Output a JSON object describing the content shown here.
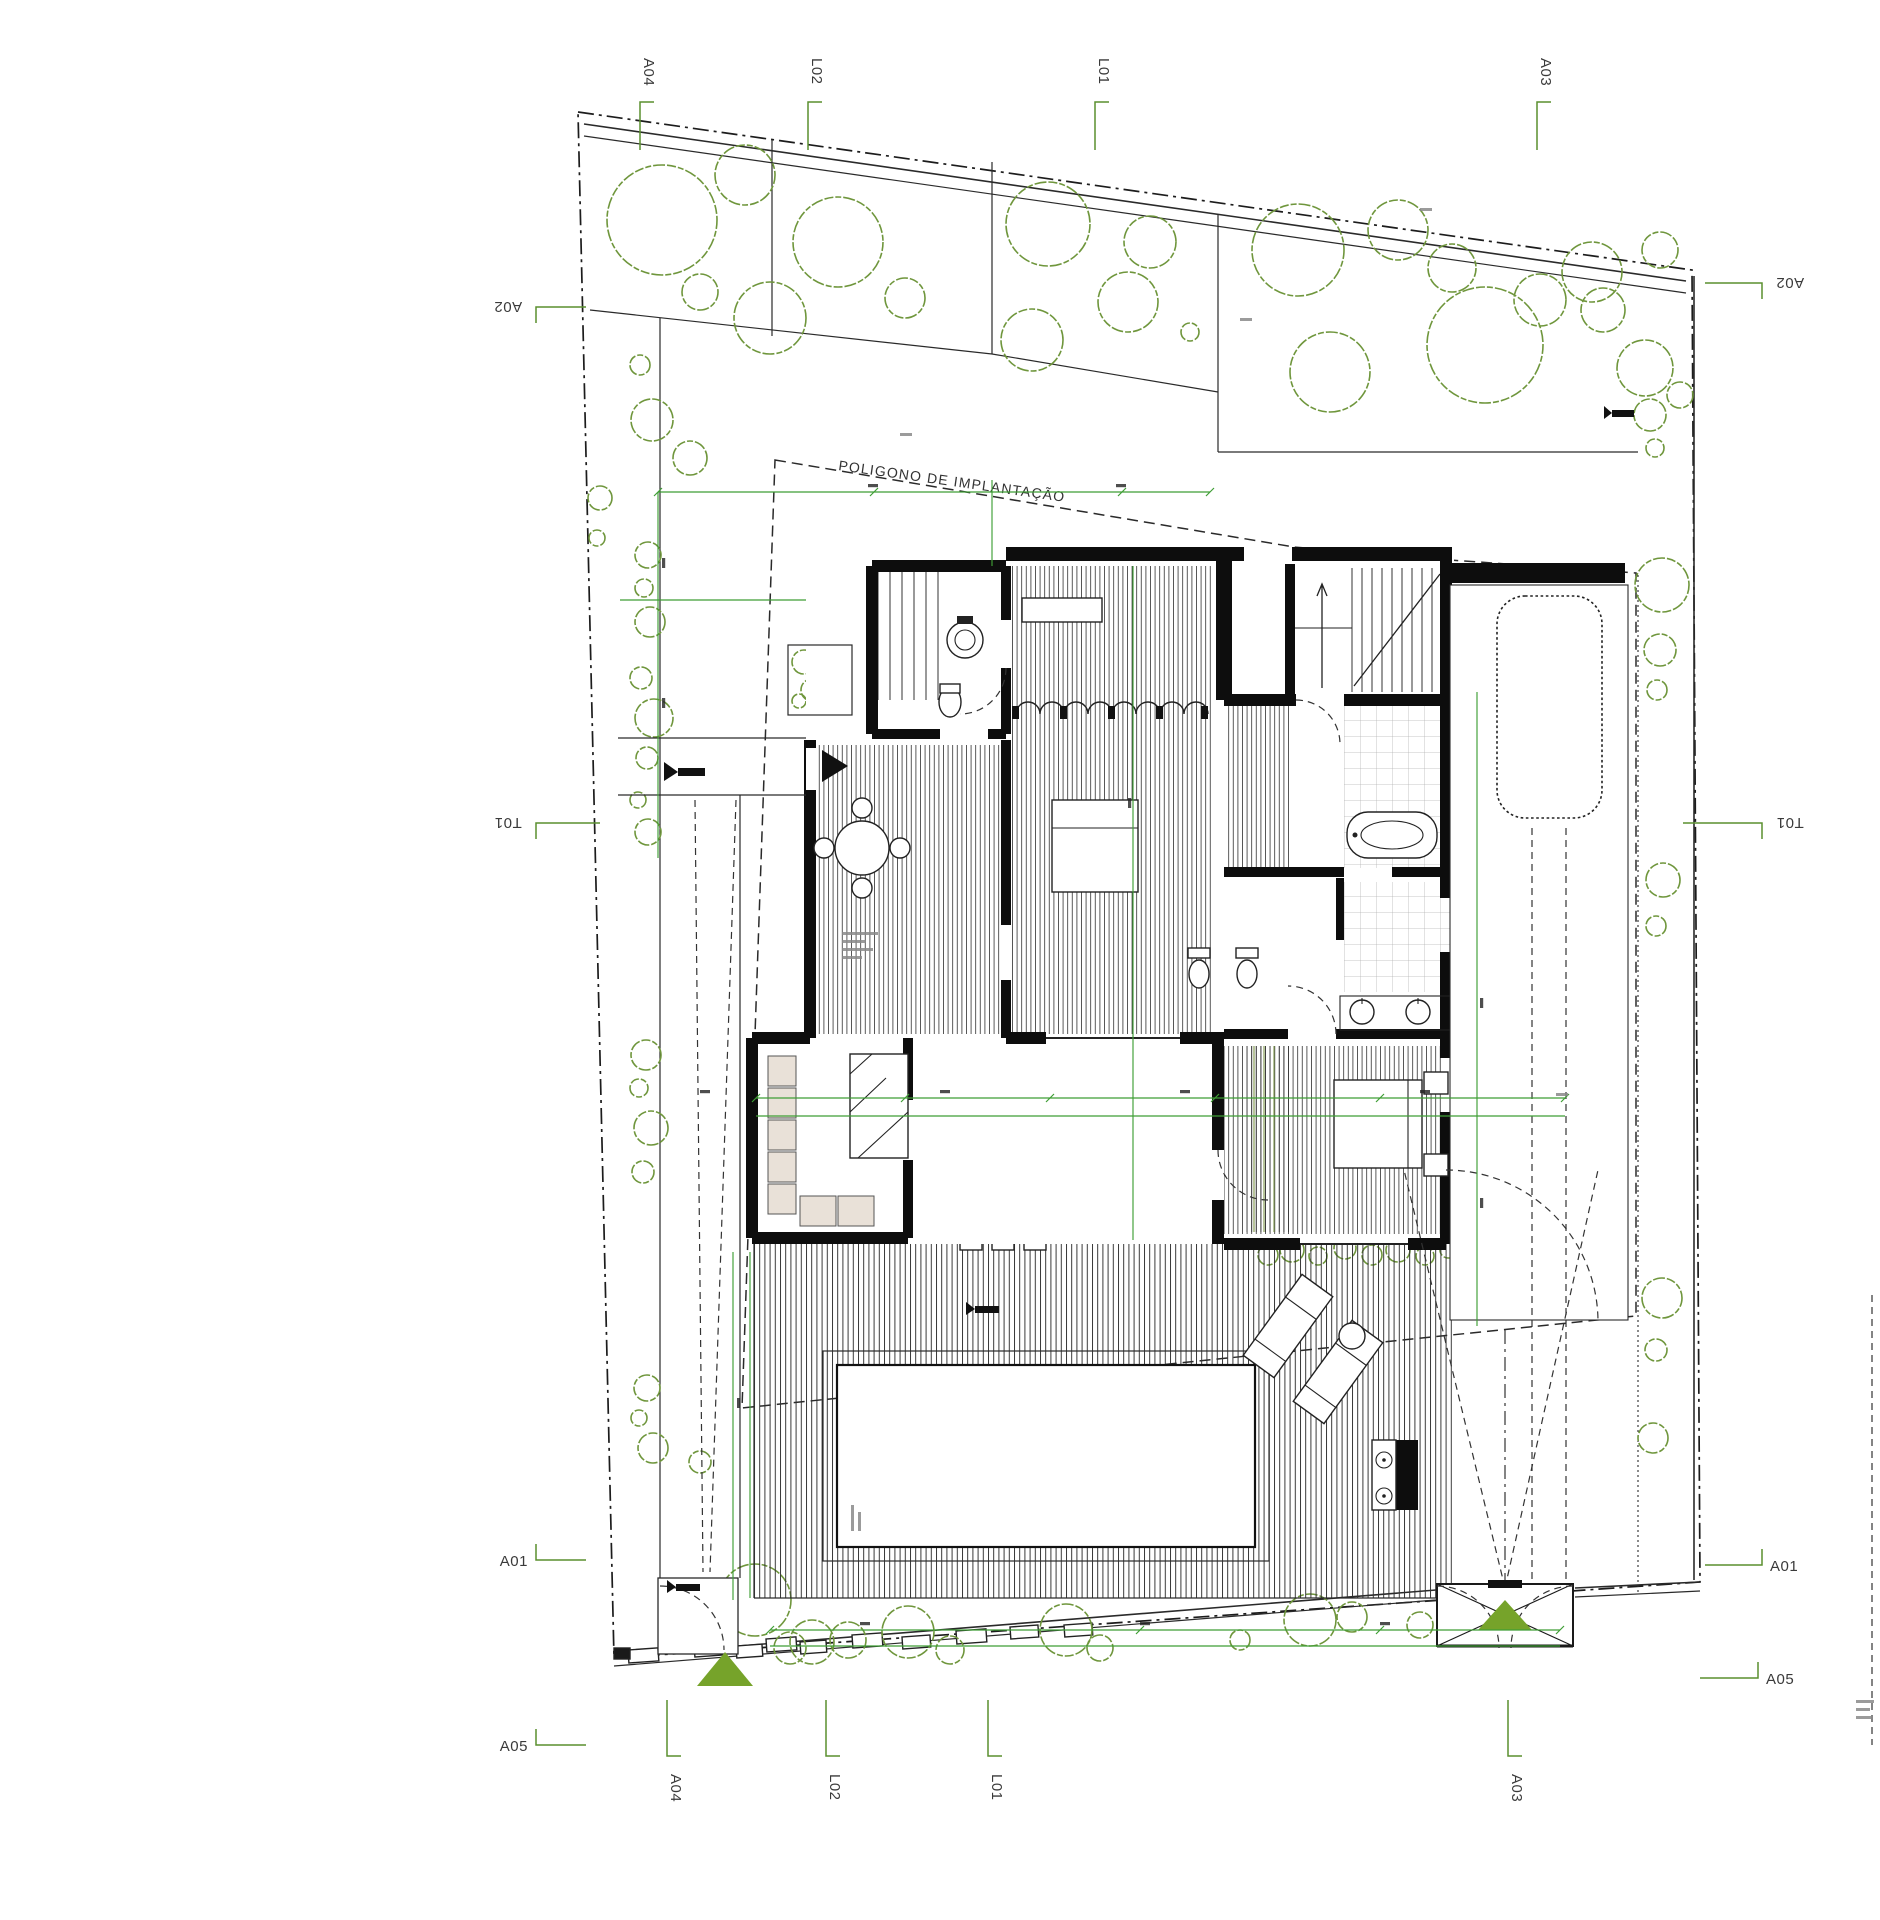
{
  "drawing": {
    "type": "architectural-site-plan",
    "annotation_label": "POLIGONO DE IMPLANTAÇÃO",
    "colors": {
      "section_marker_green": "#5a8f2f",
      "dimension_green": "#3f9e35",
      "tree_green": "#6f963c",
      "entrance_triangle_green": "#76a32a",
      "wall_black": "#0d0d0d",
      "cabinet_beige": "#e9e1d8",
      "paper_white": "#ffffff"
    },
    "markers": {
      "top": [
        {
          "label": "A04"
        },
        {
          "label": "L02"
        },
        {
          "label": "L01"
        },
        {
          "label": "A03"
        }
      ],
      "bottom": [
        {
          "label": "A04"
        },
        {
          "label": "L02"
        },
        {
          "label": "L01"
        },
        {
          "label": "A03"
        }
      ],
      "left": [
        {
          "label": "A02"
        },
        {
          "label": "T01"
        },
        {
          "label": "A01"
        },
        {
          "label": "A05"
        }
      ],
      "right": [
        {
          "label": "A02"
        },
        {
          "label": "T01"
        },
        {
          "label": "A01"
        },
        {
          "label": "A05"
        }
      ]
    }
  }
}
